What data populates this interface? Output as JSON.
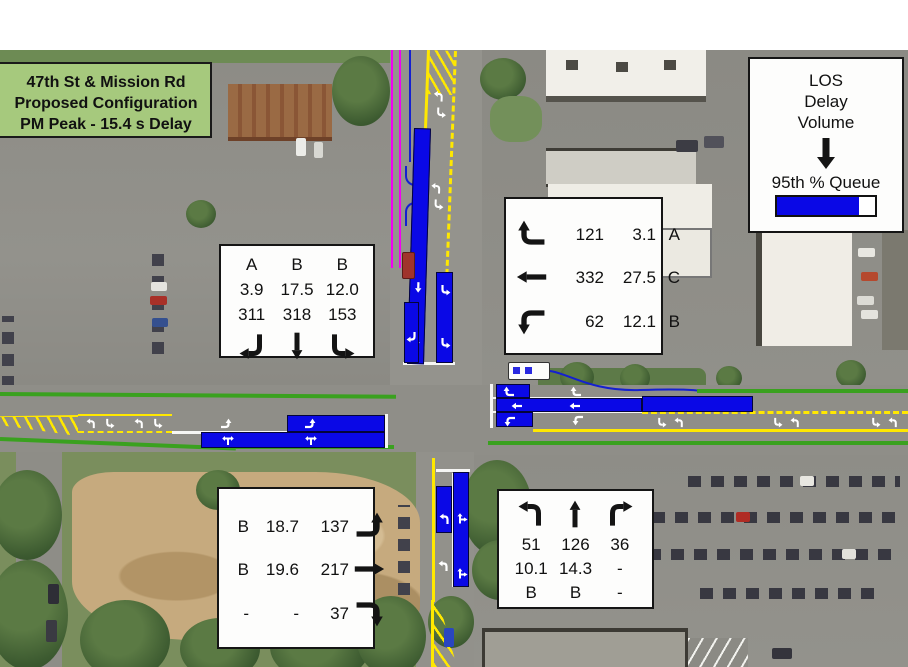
{
  "title_box": {
    "lines": [
      "47th St & Mission Rd",
      "Proposed Configuration",
      "PM Peak - 15.4 s Delay"
    ]
  },
  "legend": {
    "lines": [
      "LOS",
      "Delay",
      "Volume"
    ],
    "queue_label": "95th % Queue"
  },
  "southbound_box": {
    "los": [
      "A",
      "B",
      "B"
    ],
    "delay": [
      "3.9",
      "17.5",
      "12.0"
    ],
    "volume": [
      "311",
      "318",
      "153"
    ]
  },
  "westbound_box": {
    "rows": [
      {
        "volume": "121",
        "delay": "3.1",
        "los": "A"
      },
      {
        "volume": "332",
        "delay": "27.5",
        "los": "C"
      },
      {
        "volume": "62",
        "delay": "12.1",
        "los": "B"
      }
    ]
  },
  "eastbound_box": {
    "rows": [
      {
        "los": "B",
        "delay": "18.7",
        "volume": "137"
      },
      {
        "los": "B",
        "delay": "19.6",
        "volume": "217"
      },
      {
        "los": "-",
        "delay": "-",
        "volume": "37"
      }
    ]
  },
  "northbound_box": {
    "volume": [
      "51",
      "126",
      "36"
    ],
    "delay": [
      "10.1",
      "14.3",
      "-"
    ],
    "los": [
      "B",
      "B",
      "-"
    ]
  },
  "icons": {
    "southbound_arrows": [
      "down-then-left-arrow",
      "down-arrow",
      "down-then-right-arrow"
    ],
    "westbound_arrows": [
      "left-then-up-arrow",
      "left-arrow",
      "left-then-down-arrow"
    ],
    "eastbound_arrows": [
      "right-then-up-arrow",
      "right-arrow",
      "right-then-down-arrow"
    ],
    "northbound_arrows": [
      "up-then-left-arrow",
      "up-arrow",
      "up-then-right-arrow"
    ],
    "legend_arrow": "down-arrow"
  },
  "colors": {
    "queue_bar_blue": "#0a08e6",
    "annotation_magenta": "#f200f2",
    "curb_green": "#3aa11f",
    "lane_yellow": "#ffe800",
    "title_box_green": "#a6c97d"
  }
}
